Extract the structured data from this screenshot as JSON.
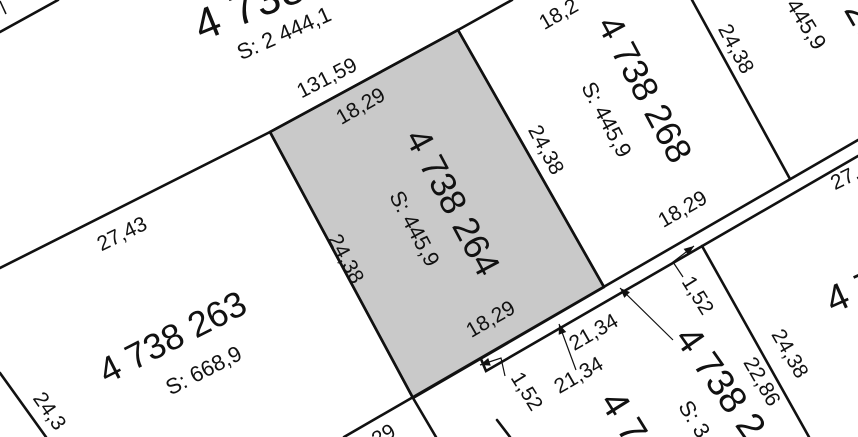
{
  "map": {
    "type": "cadastral-parcel-map",
    "colors": {
      "background": "#ffffff",
      "line": "#111111",
      "text": "#111111",
      "selected_parcel_fill": "#c9c9c9"
    },
    "parcels": {
      "selected": {
        "number": "4 738 264",
        "area": "S: 445,9"
      },
      "left": {
        "number": "4 738 263",
        "area": "S: 668,9"
      },
      "right": {
        "number": "4 738 268",
        "area": "S: 445,9"
      },
      "top": {
        "number": "4 738",
        "area": "S: 2 444,1"
      },
      "top_right": {
        "number": "26",
        "area": "445,9"
      },
      "bottom_right": {
        "number": "4 738 2",
        "area": "S: 3"
      },
      "bottom": {
        "number": "4 7"
      },
      "right_edge": {
        "number": "4 7"
      }
    },
    "dimensions": {
      "d131_59": "131,59",
      "d27_43": "27,43",
      "d18_29_sel_top": "18,29",
      "d18_29_sel_bottom": "18,29",
      "d18_29_right_s": "18,29",
      "d18_2_partial": "18,2",
      "d24_38_sel_left": "24,38",
      "d24_38_sel_right": "24,38",
      "d24_38_right_ne": "24,38",
      "d24_38_bottom_right": "24,38",
      "d24_3_partial": "24,3",
      "d22_86": "22,86",
      "d21_34_a": "21,34",
      "d21_34_b": "21,34",
      "d1_52_a": "1,52",
      "d1_52_b": "1,52",
      "d27_partial": "27,",
      "d29_partial": "29"
    }
  }
}
